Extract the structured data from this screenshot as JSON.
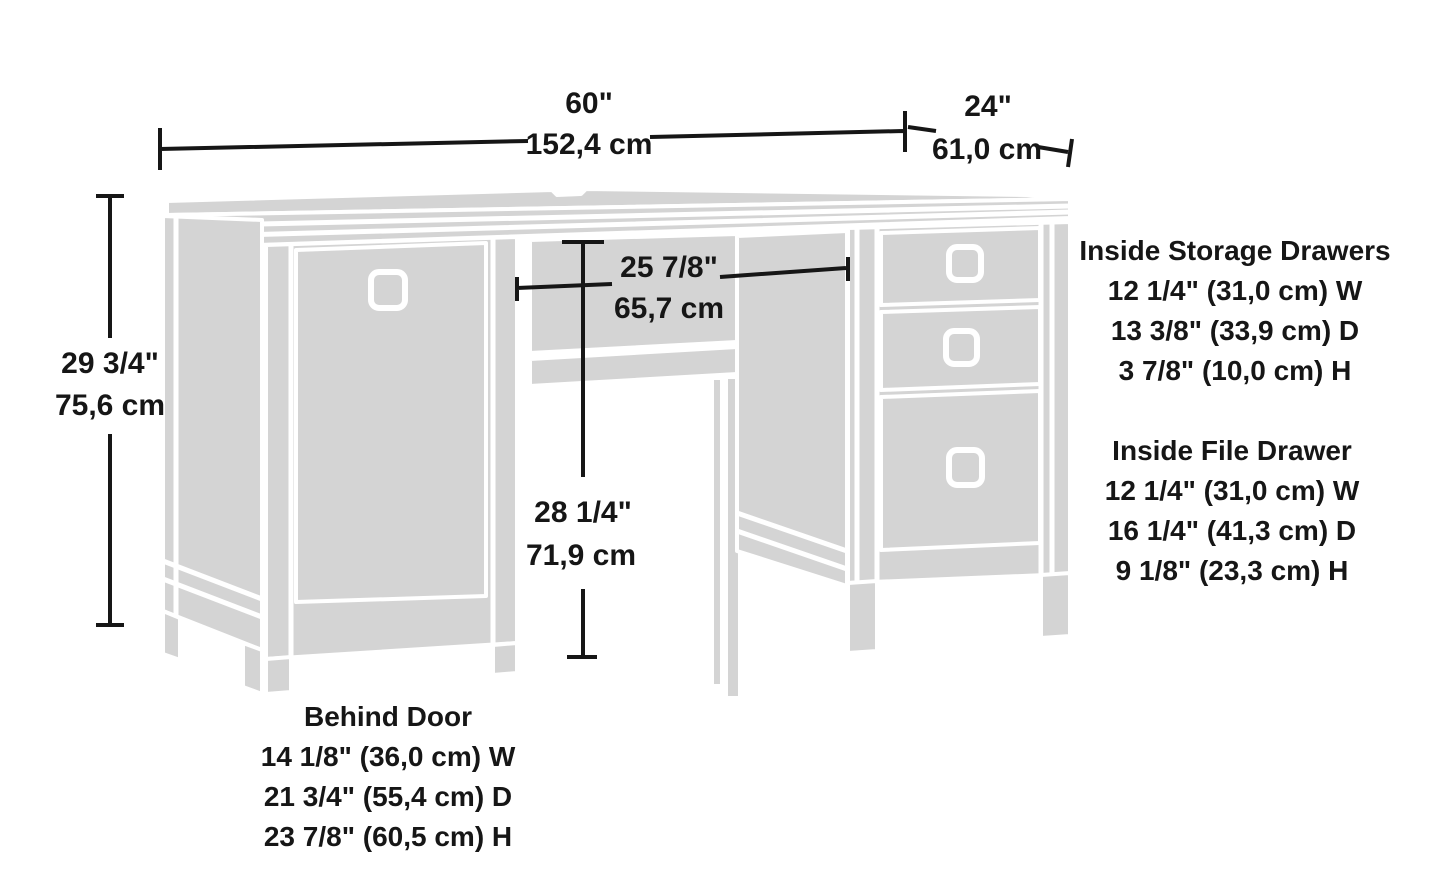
{
  "dimensions": {
    "width": {
      "in": "60\"",
      "cm": "152,4 cm"
    },
    "depth": {
      "in": "24\"",
      "cm": "61,0 cm"
    },
    "height": {
      "in": "29 3/4\"",
      "cm": "75,6 cm"
    },
    "knee_width": {
      "in": "25 7/8\"",
      "cm": "65,7 cm"
    },
    "knee_height": {
      "in": "28 1/4\"",
      "cm": "71,9 cm"
    }
  },
  "notes": {
    "storage": {
      "title": "Inside Storage Drawers",
      "line1": "12 1/4\" (31,0 cm) W",
      "line2": "13 3/8\" (33,9 cm) D",
      "line3": "3 7/8\" (10,0 cm) H"
    },
    "file": {
      "title": "Inside File Drawer",
      "line1": "12 1/4\" (31,0 cm) W",
      "line2": "16 1/4\" (41,3 cm) D",
      "line3": "9 1/8\" (23,3 cm) H"
    },
    "door": {
      "title": "Behind Door",
      "line1": "14 1/8\" (36,0 cm) W",
      "line2": "21 3/4\" (55,4 cm) D",
      "line3": "23 7/8\" (60,5 cm) H"
    }
  },
  "colors": {
    "background": "#ffffff",
    "furniture_fill": "#d4d4d4",
    "outline": "#ffffff",
    "ink": "#161616"
  }
}
